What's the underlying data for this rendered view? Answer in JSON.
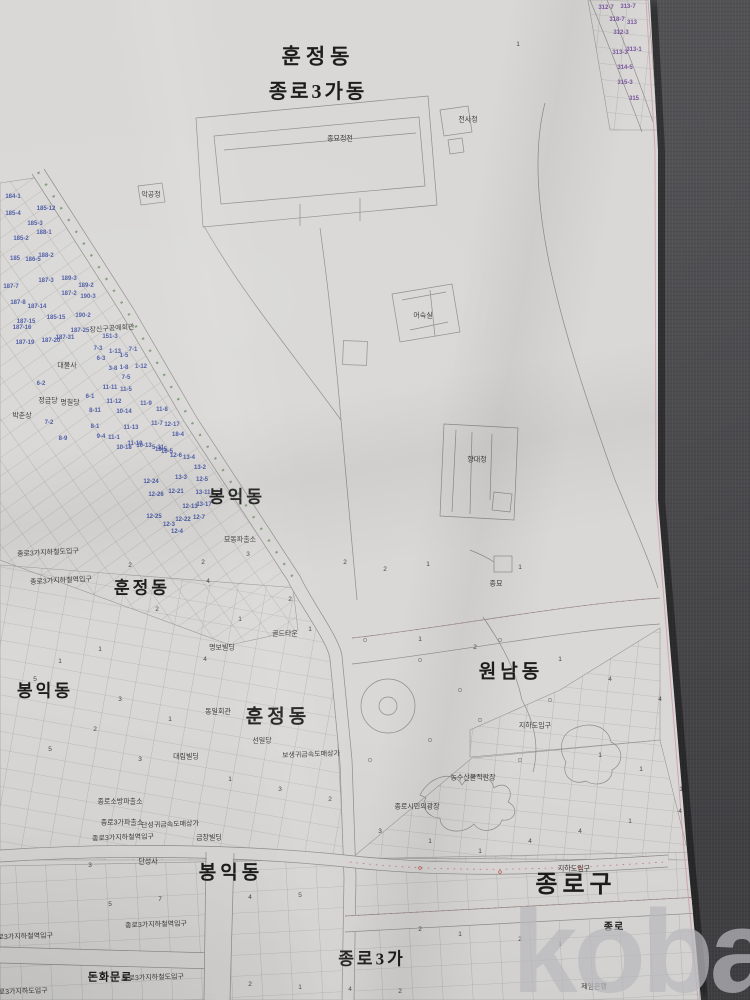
{
  "watermark": {
    "text": "kobay"
  },
  "map": {
    "colors": {
      "paper": "#d9d8d6",
      "background_fabric": "#454548",
      "line": "#8e8d8a",
      "edge_border_pink": "#cf9eae",
      "parcel_number_blue": "#4b5aa5",
      "parcel_number_purple": "#7a55a0",
      "road_accent_red": "#c05858",
      "road_accent_green": "#6b8f63"
    },
    "district_labels": [
      {
        "t": "훈정동",
        "x": 318,
        "y": 57,
        "s": 21,
        "ls": 5
      },
      {
        "t": "종로3가동",
        "x": 318,
        "y": 92,
        "s": 20,
        "ls": 3
      },
      {
        "t": "봉익동",
        "x": 237,
        "y": 497,
        "s": 17,
        "ls": 3
      },
      {
        "t": "훈정동",
        "x": 142,
        "y": 588,
        "s": 17,
        "ls": 3
      },
      {
        "t": "봉익동",
        "x": 45,
        "y": 691,
        "s": 17,
        "ls": 3
      },
      {
        "t": "훈정동",
        "x": 278,
        "y": 717,
        "s": 19,
        "ls": 4
      },
      {
        "t": "원남동",
        "x": 511,
        "y": 672,
        "s": 19,
        "ls": 4
      },
      {
        "t": "종로구",
        "x": 576,
        "y": 885,
        "s": 24,
        "ls": 5
      },
      {
        "t": "봉익동",
        "x": 231,
        "y": 873,
        "s": 19,
        "ls": 4
      },
      {
        "t": "종로3가",
        "x": 372,
        "y": 959,
        "s": 17,
        "ls": 3
      },
      {
        "t": "돈화문로",
        "x": 110,
        "y": 978,
        "s": 11,
        "ls": 1
      },
      {
        "t": "종로",
        "x": 614,
        "y": 928,
        "s": 10,
        "ls": 1
      }
    ],
    "place_labels": [
      {
        "t": "종묘정전",
        "x": 340,
        "y": 139
      },
      {
        "t": "전사청",
        "x": 468,
        "y": 120
      },
      {
        "t": "악공청",
        "x": 151,
        "y": 195
      },
      {
        "t": "어숙실",
        "x": 423,
        "y": 316
      },
      {
        "t": "향대청",
        "x": 477,
        "y": 460
      },
      {
        "t": "종묘",
        "x": 496,
        "y": 584
      },
      {
        "t": "묘동파출소",
        "x": 240,
        "y": 540
      },
      {
        "t": "종로3가지하철도입구",
        "x": 48,
        "y": 553,
        "r": -3
      },
      {
        "t": "종로3가지하철역입구",
        "x": 61,
        "y": 581,
        "r": -3
      },
      {
        "t": "골드타운",
        "x": 285,
        "y": 634
      },
      {
        "t": "명보빌딩",
        "x": 222,
        "y": 648
      },
      {
        "t": "장신구공예회관",
        "x": 112,
        "y": 329,
        "r": -4
      },
      {
        "t": "대불사",
        "x": 67,
        "y": 366
      },
      {
        "t": "정금당",
        "x": 48,
        "y": 401
      },
      {
        "t": "명칠당",
        "x": 70,
        "y": 403
      },
      {
        "t": "박춘상",
        "x": 22,
        "y": 416
      },
      {
        "t": "동일회관",
        "x": 218,
        "y": 712
      },
      {
        "t": "선일당",
        "x": 262,
        "y": 741
      },
      {
        "t": "대림빌딩",
        "x": 186,
        "y": 757
      },
      {
        "t": "보생귀금속도매상가",
        "x": 311,
        "y": 755,
        "r": -2
      },
      {
        "t": "농수산물직판장",
        "x": 473,
        "y": 778
      },
      {
        "t": "종로시민의광장",
        "x": 417,
        "y": 807
      },
      {
        "t": "지하도입구",
        "x": 535,
        "y": 726
      },
      {
        "t": "지하도입구",
        "x": 574,
        "y": 869
      },
      {
        "t": "종로소방파출소",
        "x": 120,
        "y": 802
      },
      {
        "t": "종로3가파출소",
        "x": 122,
        "y": 823
      },
      {
        "t": "단성귀금속도매상가",
        "x": 170,
        "y": 825,
        "r": -2
      },
      {
        "t": "종로3가지하철역입구",
        "x": 123,
        "y": 838,
        "r": -2
      },
      {
        "t": "금장빌딩",
        "x": 209,
        "y": 838
      },
      {
        "t": "단성사",
        "x": 148,
        "y": 862
      },
      {
        "t": "종로3가지하철역입구",
        "x": 156,
        "y": 925,
        "r": -2
      },
      {
        "t": "종로3가지하철역입구",
        "x": 22,
        "y": 937,
        "r": -2
      },
      {
        "t": "종로3가지하철도입구",
        "x": 153,
        "y": 978,
        "r": -2
      },
      {
        "t": "종로3가지하도입구",
        "x": 20,
        "y": 992,
        "r": -2
      },
      {
        "t": "제일은행",
        "x": 594,
        "y": 987
      }
    ],
    "parcel_numbers_blue": [
      {
        "t": "184-1",
        "x": 13,
        "y": 197
      },
      {
        "t": "185-12",
        "x": 46,
        "y": 209
      },
      {
        "t": "185-4",
        "x": 13,
        "y": 214
      },
      {
        "t": "185-3",
        "x": 35,
        "y": 224
      },
      {
        "t": "188-1",
        "x": 44,
        "y": 233
      },
      {
        "t": "185-2",
        "x": 21,
        "y": 239
      },
      {
        "t": "188-2",
        "x": 46,
        "y": 256
      },
      {
        "t": "185",
        "x": 15,
        "y": 259
      },
      {
        "t": "186-5",
        "x": 33,
        "y": 260
      },
      {
        "t": "187-7",
        "x": 11,
        "y": 287
      },
      {
        "t": "187-3",
        "x": 46,
        "y": 281
      },
      {
        "t": "189-3",
        "x": 69,
        "y": 279
      },
      {
        "t": "187-2",
        "x": 69,
        "y": 294
      },
      {
        "t": "189-2",
        "x": 86,
        "y": 286
      },
      {
        "t": "190-3",
        "x": 88,
        "y": 297
      },
      {
        "t": "187-8",
        "x": 18,
        "y": 303
      },
      {
        "t": "187-14",
        "x": 37,
        "y": 307
      },
      {
        "t": "190-2",
        "x": 83,
        "y": 316
      },
      {
        "t": "185-15",
        "x": 56,
        "y": 318
      },
      {
        "t": "187-15",
        "x": 26,
        "y": 322
      },
      {
        "t": "187-16",
        "x": 22,
        "y": 328
      },
      {
        "t": "187-25",
        "x": 80,
        "y": 331
      },
      {
        "t": "187-31",
        "x": 65,
        "y": 338
      },
      {
        "t": "187-20",
        "x": 51,
        "y": 341
      },
      {
        "t": "187-19",
        "x": 25,
        "y": 343
      },
      {
        "t": "151-3",
        "x": 110,
        "y": 337
      },
      {
        "t": "7-3",
        "x": 98,
        "y": 349
      },
      {
        "t": "1-13",
        "x": 115,
        "y": 352
      },
      {
        "t": "1-5",
        "x": 124,
        "y": 356
      },
      {
        "t": "7-1",
        "x": 133,
        "y": 350
      },
      {
        "t": "6-3",
        "x": 101,
        "y": 359
      },
      {
        "t": "3-8",
        "x": 113,
        "y": 369
      },
      {
        "t": "1-8",
        "x": 124,
        "y": 368
      },
      {
        "t": "1-12",
        "x": 141,
        "y": 367
      },
      {
        "t": "6-2",
        "x": 41,
        "y": 384
      },
      {
        "t": "7-5",
        "x": 126,
        "y": 378
      },
      {
        "t": "11-11",
        "x": 110,
        "y": 388
      },
      {
        "t": "11-5",
        "x": 126,
        "y": 390
      },
      {
        "t": "6-1",
        "x": 90,
        "y": 397
      },
      {
        "t": "11-12",
        "x": 114,
        "y": 402
      },
      {
        "t": "8-11",
        "x": 95,
        "y": 411
      },
      {
        "t": "10-14",
        "x": 124,
        "y": 412
      },
      {
        "t": "11-9",
        "x": 146,
        "y": 404
      },
      {
        "t": "11-8",
        "x": 162,
        "y": 410
      },
      {
        "t": "8-1",
        "x": 95,
        "y": 427
      },
      {
        "t": "11-13",
        "x": 131,
        "y": 428
      },
      {
        "t": "11-7",
        "x": 157,
        "y": 424
      },
      {
        "t": "7-2",
        "x": 49,
        "y": 423
      },
      {
        "t": "8-9",
        "x": 63,
        "y": 439
      },
      {
        "t": "9-4",
        "x": 101,
        "y": 437
      },
      {
        "t": "11-1",
        "x": 114,
        "y": 438
      },
      {
        "t": "10-18",
        "x": 124,
        "y": 448
      },
      {
        "t": "11-10",
        "x": 135,
        "y": 444
      },
      {
        "t": "10-13",
        "x": 144,
        "y": 446
      },
      {
        "t": "5-31",
        "x": 158,
        "y": 448
      },
      {
        "t": "10-5",
        "x": 167,
        "y": 452
      },
      {
        "t": "12-17",
        "x": 172,
        "y": 425
      },
      {
        "t": "18-4",
        "x": 178,
        "y": 435
      },
      {
        "t": "18-5",
        "x": 161,
        "y": 450
      },
      {
        "t": "12-6",
        "x": 176,
        "y": 456
      },
      {
        "t": "13-4",
        "x": 189,
        "y": 458
      },
      {
        "t": "13-2",
        "x": 200,
        "y": 468
      },
      {
        "t": "12-24",
        "x": 151,
        "y": 482
      },
      {
        "t": "13-3",
        "x": 181,
        "y": 478
      },
      {
        "t": "12-5",
        "x": 202,
        "y": 480
      },
      {
        "t": "12-26",
        "x": 156,
        "y": 495
      },
      {
        "t": "12-21",
        "x": 176,
        "y": 492
      },
      {
        "t": "13-11",
        "x": 203,
        "y": 493
      },
      {
        "t": "12-13",
        "x": 190,
        "y": 507
      },
      {
        "t": "13-17",
        "x": 204,
        "y": 505
      },
      {
        "t": "12-25",
        "x": 154,
        "y": 517
      },
      {
        "t": "12-22",
        "x": 183,
        "y": 520
      },
      {
        "t": "12-7",
        "x": 199,
        "y": 518
      },
      {
        "t": "12-3",
        "x": 169,
        "y": 525
      },
      {
        "t": "12-4",
        "x": 177,
        "y": 532
      }
    ],
    "parcel_numbers_purple": [
      {
        "t": "312-7",
        "x": 606,
        "y": 8
      },
      {
        "t": "313-7",
        "x": 628,
        "y": 7
      },
      {
        "t": "318-7",
        "x": 617,
        "y": 20
      },
      {
        "t": "313",
        "x": 632,
        "y": 23
      },
      {
        "t": "312-3",
        "x": 621,
        "y": 33
      },
      {
        "t": "313-3",
        "x": 620,
        "y": 53
      },
      {
        "t": "313-1",
        "x": 634,
        "y": 50
      },
      {
        "t": "314-5",
        "x": 625,
        "y": 68
      },
      {
        "t": "315-3",
        "x": 625,
        "y": 83
      },
      {
        "t": "315",
        "x": 634,
        "y": 99
      }
    ],
    "lot_digits": [
      {
        "t": "3",
        "x": 248,
        "y": 555
      },
      {
        "t": "2",
        "x": 203,
        "y": 563
      },
      {
        "t": "2",
        "x": 130,
        "y": 566
      },
      {
        "t": "2",
        "x": 345,
        "y": 563
      },
      {
        "t": "2",
        "x": 385,
        "y": 570
      },
      {
        "t": "1",
        "x": 428,
        "y": 565
      },
      {
        "t": "1",
        "x": 520,
        "y": 568
      },
      {
        "t": "4",
        "x": 208,
        "y": 582
      },
      {
        "t": "2",
        "x": 290,
        "y": 600
      },
      {
        "t": "2",
        "x": 157,
        "y": 610
      },
      {
        "t": "1",
        "x": 240,
        "y": 620
      },
      {
        "t": "1",
        "x": 310,
        "y": 630
      },
      {
        "t": "1",
        "x": 420,
        "y": 640
      },
      {
        "t": "2",
        "x": 475,
        "y": 648
      },
      {
        "t": "1",
        "x": 560,
        "y": 660
      },
      {
        "t": "4",
        "x": 610,
        "y": 680
      },
      {
        "t": "4",
        "x": 660,
        "y": 700
      },
      {
        "t": "4",
        "x": 205,
        "y": 660
      },
      {
        "t": "1",
        "x": 100,
        "y": 650
      },
      {
        "t": "1",
        "x": 60,
        "y": 662
      },
      {
        "t": "5",
        "x": 35,
        "y": 680
      },
      {
        "t": "3",
        "x": 120,
        "y": 700
      },
      {
        "t": "1",
        "x": 170,
        "y": 720
      },
      {
        "t": "2",
        "x": 95,
        "y": 730
      },
      {
        "t": "5",
        "x": 50,
        "y": 750
      },
      {
        "t": "3",
        "x": 140,
        "y": 760
      },
      {
        "t": "1",
        "x": 230,
        "y": 780
      },
      {
        "t": "3",
        "x": 280,
        "y": 790
      },
      {
        "t": "2",
        "x": 330,
        "y": 800
      },
      {
        "t": "3",
        "x": 380,
        "y": 832
      },
      {
        "t": "1",
        "x": 430,
        "y": 842
      },
      {
        "t": "1",
        "x": 480,
        "y": 852
      },
      {
        "t": "4",
        "x": 530,
        "y": 842
      },
      {
        "t": "4",
        "x": 580,
        "y": 832
      },
      {
        "t": "1",
        "x": 630,
        "y": 822
      },
      {
        "t": "4",
        "x": 680,
        "y": 812
      },
      {
        "t": "3",
        "x": 90,
        "y": 866
      },
      {
        "t": "5",
        "x": 110,
        "y": 905
      },
      {
        "t": "7",
        "x": 160,
        "y": 900
      },
      {
        "t": "4",
        "x": 250,
        "y": 898
      },
      {
        "t": "5",
        "x": 300,
        "y": 896
      },
      {
        "t": "2",
        "x": 420,
        "y": 930
      },
      {
        "t": "1",
        "x": 460,
        "y": 935
      },
      {
        "t": "2",
        "x": 520,
        "y": 940
      },
      {
        "t": "1",
        "x": 560,
        "y": 945
      },
      {
        "t": "2",
        "x": 250,
        "y": 985
      },
      {
        "t": "1",
        "x": 300,
        "y": 988
      },
      {
        "t": "4",
        "x": 350,
        "y": 990
      },
      {
        "t": "2",
        "x": 400,
        "y": 992
      },
      {
        "t": "1",
        "x": 600,
        "y": 756
      },
      {
        "t": "1",
        "x": 641,
        "y": 770
      },
      {
        "t": "1",
        "x": 681,
        "y": 790
      },
      {
        "t": "1",
        "x": 518,
        "y": 45
      }
    ]
  }
}
